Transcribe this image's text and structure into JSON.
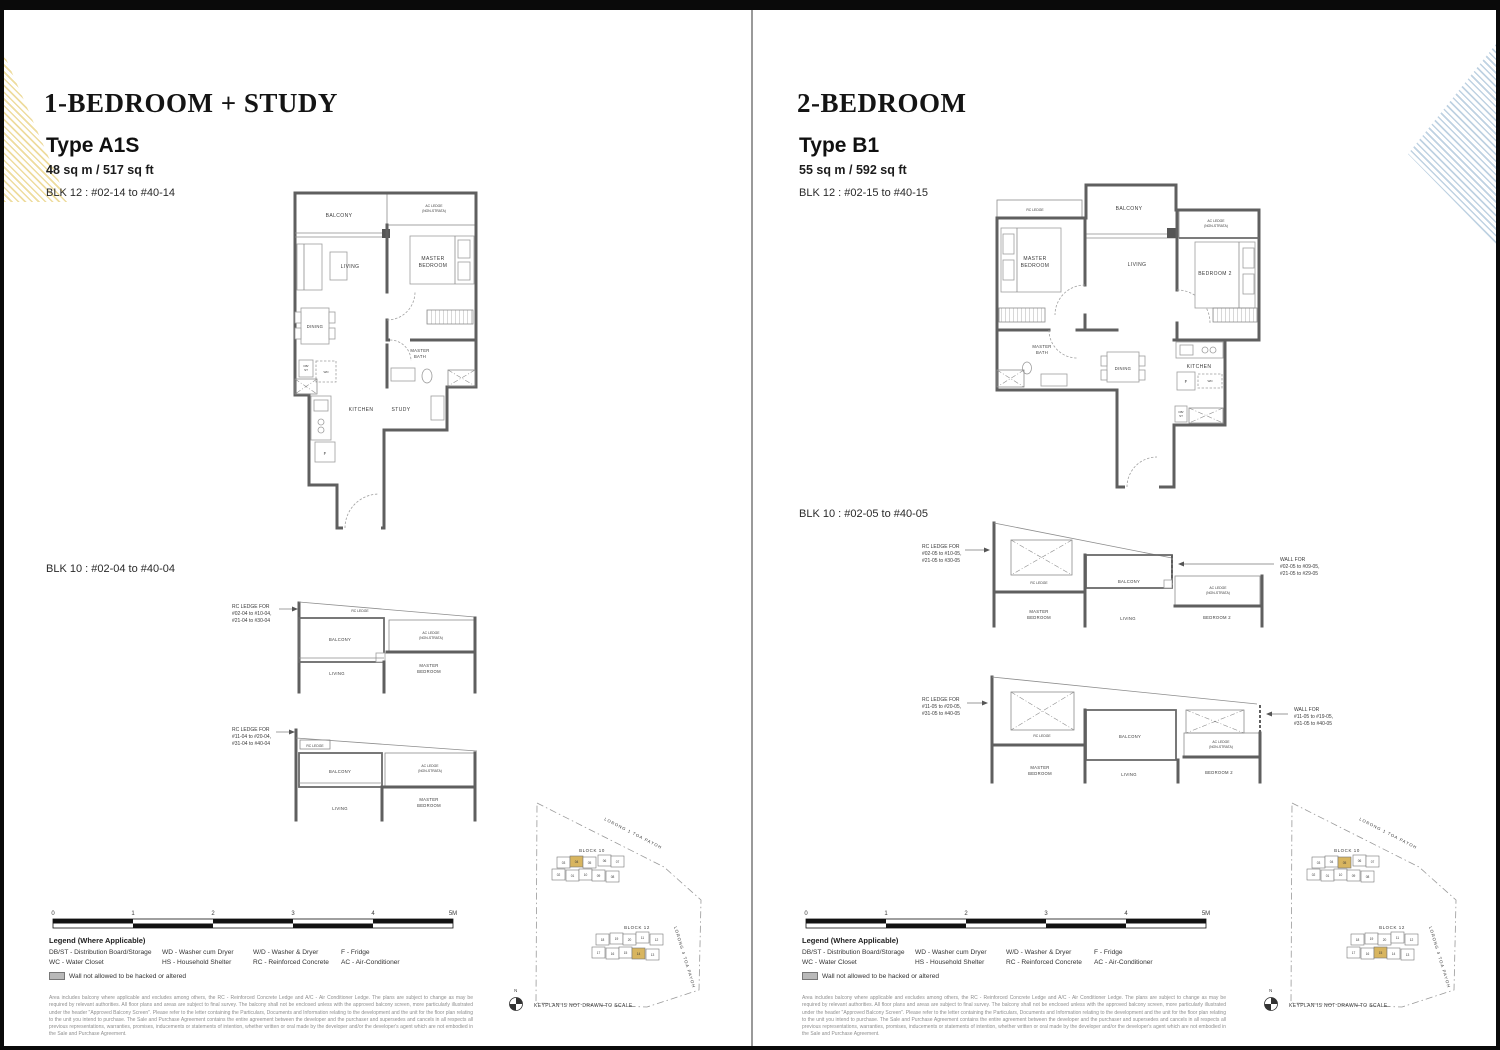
{
  "shared": {
    "scale": {
      "ticks": [
        "0",
        "1",
        "2",
        "3",
        "4",
        "5M"
      ]
    },
    "legend": {
      "title": "Legend (Where Applicable)",
      "col1": [
        "DB/ST - Distribution Board/Storage",
        "WC - Water Closet"
      ],
      "col2": [
        "WD - Washer cum Dryer",
        "HS - Household Shelter"
      ],
      "col3": [
        "W/D - Washer & Dryer",
        "RC - Reinforced Concrete"
      ],
      "col4": [
        "F - Fridge",
        "AC - Air-Conditioner"
      ],
      "wall_note": "Wall not allowed to be hacked or altered"
    },
    "disclaimer": "Area includes balcony where applicable and excludes among others, the RC - Reinforced Concrete Ledge and A/C - Air Conditioner Ledge. The plans are subject to change as may be required by relevant authorities. All floor plans and areas are subject to final survey. The balcony shall not be enclosed unless with the approved balcony screen, more particularly illustrated under the header \"Approved Balcony Screen\". Please refer to the letter containing the Particulars, Documents and Information relating to the development and the unit for the floor plan relating to the unit you intend to purchase. The Sale and Purchase Agreement contains the entire agreement between the developer and the purchaser and supersedes and cancels in all respects all previous representations, warranties, promises, inducements or statements of intention, whether written or oral made by the developer and/or the developer's agent which are not embodied in the Sale and Purchase Agreement.",
    "keyplan": {
      "block10": "BLOCK 10",
      "block12": "BLOCK 12",
      "road1": "LORONG 1 TOA PAYOH",
      "road2": "LORONG 4 TOA PAYOH",
      "north": "N",
      "note": "KEYPLAN IS NOT DRAWN TO SCALE",
      "b10_top": [
        "03",
        "04",
        "05",
        "06",
        "07"
      ],
      "b10_bot": [
        "02",
        "01",
        "10",
        "09",
        "08"
      ],
      "b12_top": [
        "18",
        "19",
        "20",
        "11",
        "12"
      ],
      "b12_bot": [
        "17",
        "16",
        "15",
        "14",
        "13"
      ]
    },
    "rooms": {
      "balcony": "BALCONY",
      "ac1": "AC LEDGE",
      "ac2": "(NON-STRATA)",
      "living": "LIVING",
      "master": "MASTER",
      "bedroom": "BEDROOM",
      "bedroom2": "BEDROOM 2",
      "bath": "BATH",
      "dining": "DINING",
      "kitchen": "KITCHEN",
      "study": "STUDY",
      "rc": "RC LEDGE",
      "f": "F",
      "wd": "WD",
      "db1": "DB/",
      "db2": "ST"
    },
    "colors": {
      "highlight": "#d8b55f",
      "accent_yellow": "#eedc9e",
      "accent_blue": "#bfd2e2"
    }
  },
  "left": {
    "category": "1-BEDROOM + STUDY",
    "type": "Type A1S",
    "area": "48 sq m / 517 sq ft",
    "blk12": "BLK 12 : #02-14 to #40-14",
    "blk10": "BLK 10 : #02-04 to #40-04",
    "p1_ann": [
      "RC LEDGE FOR",
      "#02-04 to #10-04,",
      "#21-04 to #30-04"
    ],
    "p2_ann": [
      "RC LEDGE FOR",
      "#11-04 to #20-04,",
      "#31-04 to #40-04"
    ]
  },
  "right": {
    "category": "2-BEDROOM",
    "type": "Type B1",
    "area": "55 sq m / 592 sq ft",
    "blk12": "BLK 12 : #02-15 to #40-15",
    "blk10": "BLK 10 : #02-05 to #40-05",
    "p1_ann_l": [
      "RC LEDGE FOR",
      "#02-05 to #10-05,",
      "#21-05 to #30-05"
    ],
    "p1_ann_r": [
      "WALL FOR",
      "#02-05 to #09-05,",
      "#21-05 to #29-05"
    ],
    "p2_ann_l": [
      "RC LEDGE FOR",
      "#11-05 to #20-05,",
      "#31-05 to #40-05"
    ],
    "p2_ann_r": [
      "WALL FOR",
      "#11-05 to #19-05,",
      "#31-05 to #40-05"
    ]
  }
}
